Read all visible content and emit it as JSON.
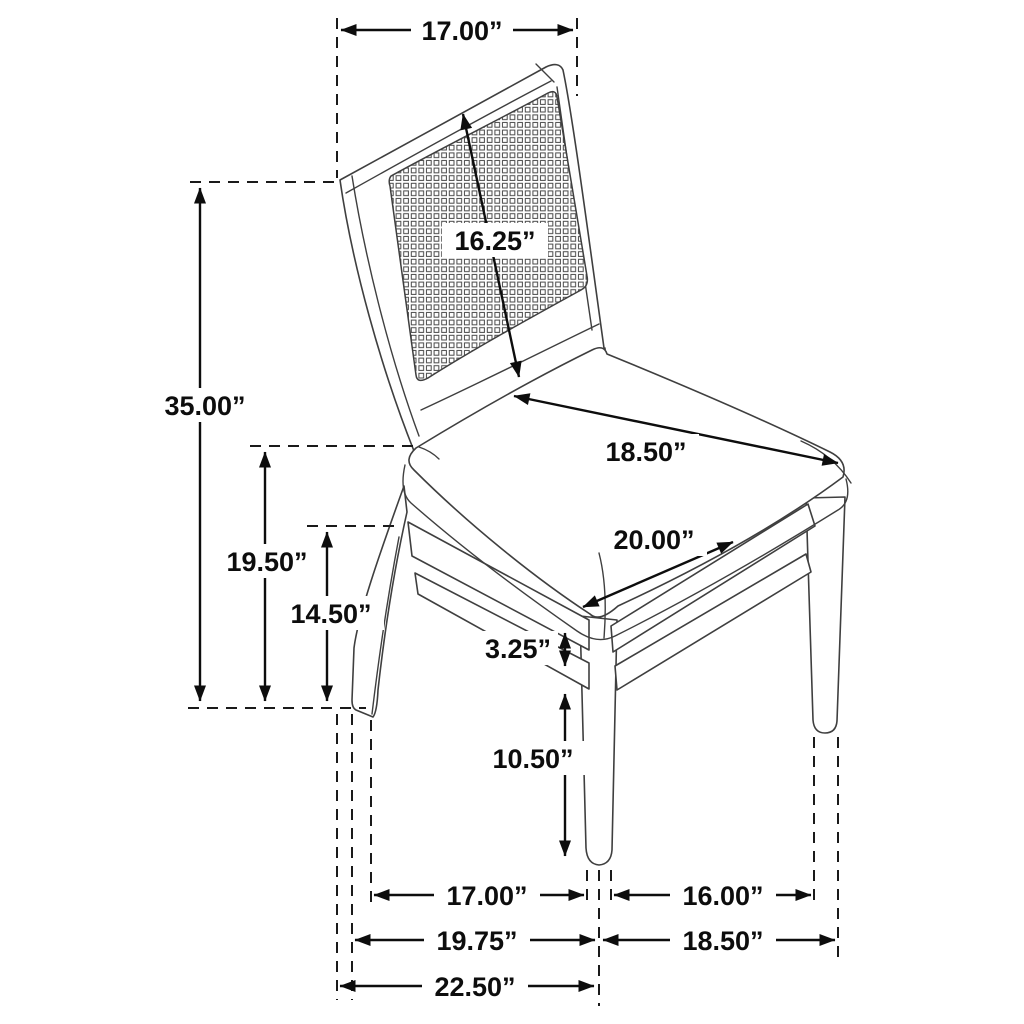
{
  "meta": {
    "subject": "dining-chair-dimension-diagram",
    "description": "Three-quarter line drawing of a cane-back dining side chair with upholstered seat and dimension callouts",
    "units": "inches",
    "colors": {
      "background": "#ffffff",
      "chair_line": "#3f3f3f",
      "dimension_line": "#0d0d0d"
    }
  },
  "dims": {
    "back_top_width": "17.00”",
    "back_panel_diagonal": "16.25”",
    "overall_height": "35.00”",
    "seat_top_height": "19.50”",
    "seat_frame_height": "14.50”",
    "seat_width": "18.50”",
    "seat_depth": "20.00”",
    "apron_stretcher_gap": "3.25”",
    "leg_lower_height": "10.50”",
    "base_inner_depth": "17.00”",
    "base_mid_depth": "19.75”",
    "base_overall_depth": "22.50”",
    "base_inner_width": "16.00”",
    "base_overall_width": "18.50”"
  }
}
